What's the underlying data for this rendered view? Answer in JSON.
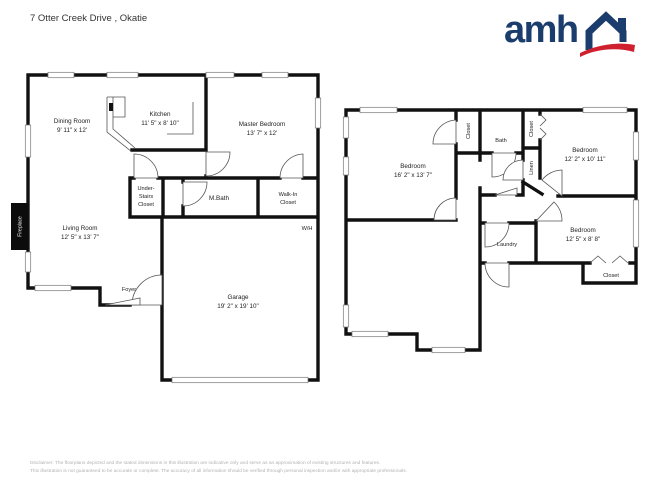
{
  "header": {
    "title": "7 Otter Creek Drive , Okatie"
  },
  "logo": {
    "text": "amh",
    "navy": "#1b3d6d",
    "red": "#cf2030"
  },
  "floor1": {
    "rooms": {
      "dining": {
        "label": "Dining Room",
        "dims": "9' 11\" x 12'"
      },
      "kitchen": {
        "label": "Kitchen",
        "dims": "11' 5\" x 8' 10\""
      },
      "master": {
        "label": "Master Bedroom",
        "dims": "13' 7\" x 12'"
      },
      "understairs": {
        "line1": "Under-",
        "line2": "Stairs",
        "line3": "Closet"
      },
      "mbath": {
        "label": "M.Bath"
      },
      "walkin": {
        "line1": "Walk-In",
        "line2": "Closet"
      },
      "living": {
        "label": "Living Room",
        "dims": "12' 5\" x 13' 7\""
      },
      "foyer": {
        "label": "Foyer"
      },
      "garage": {
        "label": "Garage",
        "dims": "19' 2\" x 19' 10\""
      },
      "wh": {
        "label": "W/H"
      },
      "fireplace": {
        "label": "Fireplace"
      }
    }
  },
  "floor2": {
    "rooms": {
      "bedroom1": {
        "label": "Bedroom",
        "dims": "16' 2\" x 13' 7\""
      },
      "bedroom2": {
        "label": "Bedroom",
        "dims": "12' 2\" x 10' 11\""
      },
      "bedroom3": {
        "label": "Bedroom",
        "dims": "12' 5\" x 8' 8\""
      },
      "bath": {
        "label": "Bath"
      },
      "closet_a": {
        "label": "Closet"
      },
      "closet_b": {
        "label": "Closet"
      },
      "linen": {
        "label": "Linen"
      },
      "laundry": {
        "label": "Laundry"
      },
      "closet_c": {
        "label": "Closet"
      }
    }
  },
  "footer": {
    "line1": "Disclaimer: The floorplans depicted and the stated dimensions in this illustration are indicative only and serve as an approximation of existing structures and features.",
    "line2": "This illustration is not guaranteed to be accurate or complete. The accuracy of all information should be verified through personal inspection and/or with appropriate professionals."
  }
}
